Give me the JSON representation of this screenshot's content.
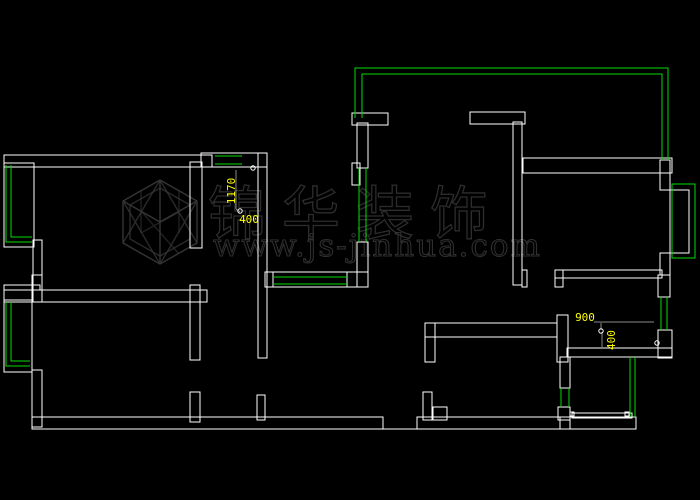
{
  "colors": {
    "background": "#000000",
    "wall": "#ffffff",
    "window": "#00dd00",
    "dimension": "#ffff00",
    "leader": "#8a8a8a",
    "watermark": "#353535"
  },
  "watermark": {
    "company": "锦华装饰",
    "url": "www.js-jinhua.com"
  },
  "dimensions": {
    "hall_height": {
      "value": "1170",
      "orientation": "vertical"
    },
    "hall_width": {
      "value": "400",
      "orientation": "horizontal"
    },
    "bath_width": {
      "value": "900",
      "orientation": "horizontal"
    },
    "bath_depth": {
      "value": "400",
      "orientation": "vertical"
    }
  }
}
